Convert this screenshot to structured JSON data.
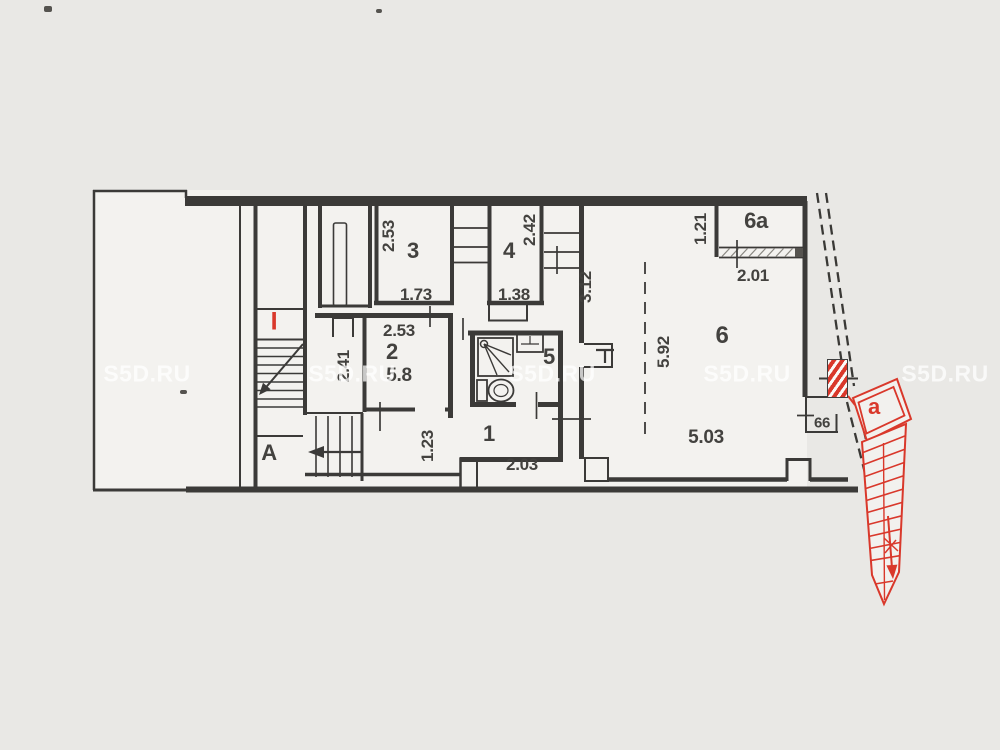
{
  "palette": {
    "paper": "#e9e8e5",
    "room_fill": "#f3f2ef",
    "line": "#3b3a38",
    "red": "#d9382b"
  },
  "watermark": {
    "text": "S5D.RU",
    "positions": [
      {
        "x": 147,
        "y": 374
      },
      {
        "x": 352,
        "y": 374
      },
      {
        "x": 552,
        "y": 374
      },
      {
        "x": 747,
        "y": 374
      },
      {
        "x": 945,
        "y": 374
      }
    ]
  },
  "labels": [
    {
      "name": "dim-room3-height",
      "text": "2.53",
      "x": 389,
      "y": 236,
      "cls": "v"
    },
    {
      "name": "room3-number",
      "text": "3",
      "x": 413,
      "y": 251,
      "cls": "room"
    },
    {
      "name": "dim-room3-width",
      "text": "1.73",
      "x": 416,
      "y": 295,
      "cls": ""
    },
    {
      "name": "room4-number",
      "text": "4",
      "x": 509,
      "y": 251,
      "cls": "room"
    },
    {
      "name": "dim-room4-height",
      "text": "2.42",
      "x": 530,
      "y": 230,
      "cls": "v"
    },
    {
      "name": "dim-room4-width",
      "text": "1.38",
      "x": 514,
      "y": 295,
      "cls": ""
    },
    {
      "name": "dim-room6-left-height",
      "text": "3.12",
      "x": 586,
      "y": 287,
      "cls": "v"
    },
    {
      "name": "dim-room2-width",
      "text": "2.53",
      "x": 399,
      "y": 331,
      "cls": ""
    },
    {
      "name": "room2-number",
      "text": "2",
      "x": 392,
      "y": 352,
      "cls": "room"
    },
    {
      "name": "room2-area",
      "text": "5.8",
      "x": 399,
      "y": 376,
      "cls": "md"
    },
    {
      "name": "dim-room2-height",
      "text": "2.41",
      "x": 344,
      "y": 366,
      "cls": "v"
    },
    {
      "name": "room5-number",
      "text": "5",
      "x": 549,
      "y": 357,
      "cls": "room"
    },
    {
      "name": "dim-corridor-height",
      "text": "1.23",
      "x": 428,
      "y": 446,
      "cls": "v"
    },
    {
      "name": "room1-number",
      "text": "1",
      "x": 489,
      "y": 434,
      "cls": "room"
    },
    {
      "name": "dim-corridor-width",
      "text": "2.03",
      "x": 522,
      "y": 465,
      "cls": ""
    },
    {
      "name": "stair-zone-label",
      "text": "A",
      "x": 269,
      "y": 453,
      "cls": "room"
    },
    {
      "name": "room6-number",
      "text": "6",
      "x": 722,
      "y": 336,
      "cls": "room-lg"
    },
    {
      "name": "room6a-number",
      "text": "6a",
      "x": 756,
      "y": 221,
      "cls": "room"
    },
    {
      "name": "dim-room6a-height",
      "text": "1.21",
      "x": 701,
      "y": 229,
      "cls": "v"
    },
    {
      "name": "dim-room6a-width",
      "text": "2.01",
      "x": 753,
      "y": 276,
      "cls": ""
    },
    {
      "name": "dim-room6-height",
      "text": "5.92",
      "x": 664,
      "y": 352,
      "cls": "v"
    },
    {
      "name": "dim-room6-width",
      "text": "5.03",
      "x": 706,
      "y": 438,
      "cls": "md"
    },
    {
      "name": "dim-ledge",
      "text": "66",
      "x": 822,
      "y": 423,
      "cls": "sm"
    },
    {
      "name": "external-stair-label",
      "text": "a",
      "x": 874,
      "y": 407,
      "cls": "room red"
    },
    {
      "name": "floor-marker",
      "text": "I",
      "x": 274,
      "y": 322,
      "cls": "marker red"
    }
  ]
}
